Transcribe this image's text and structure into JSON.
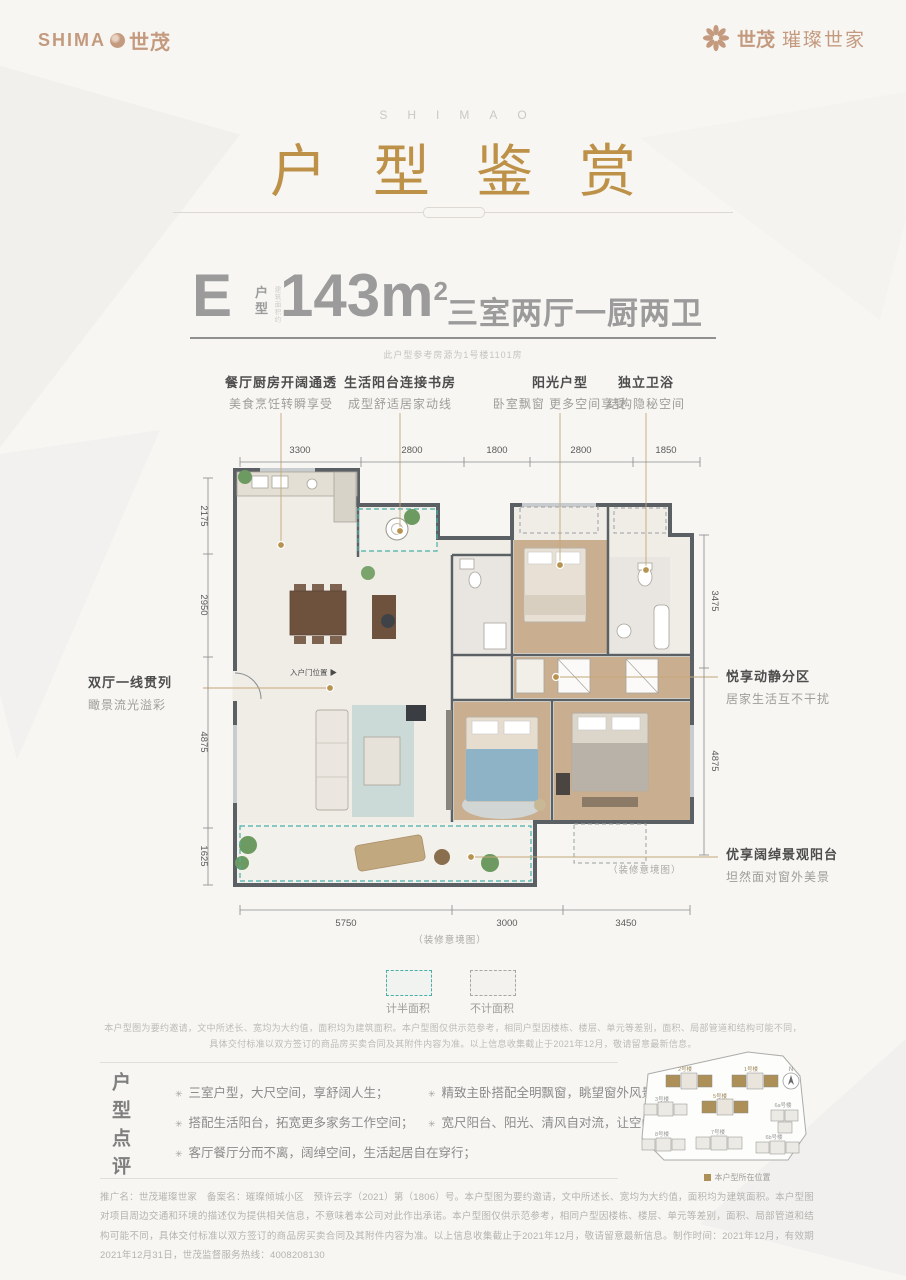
{
  "header": {
    "logo_left_en": "SHIMA",
    "logo_left_cn": "世茂",
    "logo_right_brand": "世茂",
    "logo_right_name": "璀璨世家"
  },
  "title": {
    "eyebrow": "SHIMAO",
    "main": "户型鉴赏"
  },
  "spec": {
    "type_letter": "E",
    "type_label_1": "户",
    "type_label_2": "型",
    "area_note": "建筑面积约",
    "area_value": "143m",
    "area_sup": "2",
    "rooms": "三室两厅一厨两卫",
    "ref_note": "此户型参考房源为1号楼1101房"
  },
  "features": [
    {
      "title": "餐厅厨房开阔通透",
      "desc": "美食烹饪转瞬享受"
    },
    {
      "title": "生活阳台连接书房",
      "desc": "成型舒适居家动线"
    },
    {
      "title": "阳光户型",
      "desc": "卧室飘窗 更多空间享受"
    },
    {
      "title": "独立卫浴",
      "desc": "结构隐秘空间"
    }
  ],
  "dims": {
    "top": [
      "3300",
      "2800",
      "1800",
      "2800",
      "1850"
    ],
    "left": [
      "2175",
      "2950",
      "4875",
      "1625"
    ],
    "right": [
      "3475",
      "4875"
    ],
    "bottom": [
      "5750",
      "3000",
      "3450"
    ]
  },
  "callouts": {
    "entry_door": "入户门位置 ▶",
    "left_title": "双厅一线贯列",
    "left_desc": "瞰景流光溢彩",
    "right_top_title": "悦享动静分区",
    "right_top_desc": "居家生活互不干扰",
    "right_bottom_title": "优享阔绰景观阳台",
    "right_bottom_desc": "坦然面对窗外美景",
    "render_note": "（装修意境图）"
  },
  "legend": {
    "half_area": "计半面积",
    "excluded_area": "不计面积"
  },
  "disclaimer": {
    "line1": "本户型图为要约邀请，文中所述长、宽均为大约值，面积均为建筑面积。本户型图仅供示范参考，相同户型因楼栋、楼层、单元等差别，面积、局部管道和结构可能不同，",
    "line2": "具体交付标准以双方签订的商品房买卖合同及其附件内容为准。以上信息收集截止于2021年12月，敬请留意最新信息。"
  },
  "review": {
    "heading": "户型点评",
    "bullet_icon": "✳",
    "left": [
      "三室户型，大尺空间，享舒阔人生；",
      "搭配生活阳台，拓宽更多家务工作空间；",
      "客厅餐厅分而不离，阔绰空间，生活起居自在穿行；"
    ],
    "right": [
      "精致主卧搭配全明飘窗，眺望窗外风景；",
      "宽尺阳台、阳光、清风自对流，让空间自由延伸。"
    ]
  },
  "siteplan": {
    "compass": "N",
    "buildings": [
      "2号楼",
      "1号楼",
      "3号楼",
      "5号楼",
      "6a号楼",
      "8号楼",
      "7号楼",
      "6b号楼"
    ],
    "legend": "本户型所在位置"
  },
  "footer": {
    "text": "推广名：世茂璀璨世家　备案名：璀璨倾城小区　预许云字（2021）第（1806）号。本户型图为要约邀请，文中所述长、宽均为大约值，面积均为建筑面积。本户型图对项目周边交通和环境的描述仅为提供相关信息，不意味着本公司对此作出承诺。本户型图仅供示范参考，相同户型因楼栋、楼层、单元等差别，面积、局部管道和结构可能不同，具体交付标准以双方签订的商品房买卖合同及其附件内容为准。以上信息收集截止于2021年12月，敬请留意最新信息。制作时间：2021年12月，有效期2021年12月31日，世茂监督服务热线：4008208130"
  },
  "colors": {
    "gold": "#bd9148",
    "tan": "#c49a7e",
    "teal": "#49b0a8",
    "wall": "#5b6065"
  }
}
